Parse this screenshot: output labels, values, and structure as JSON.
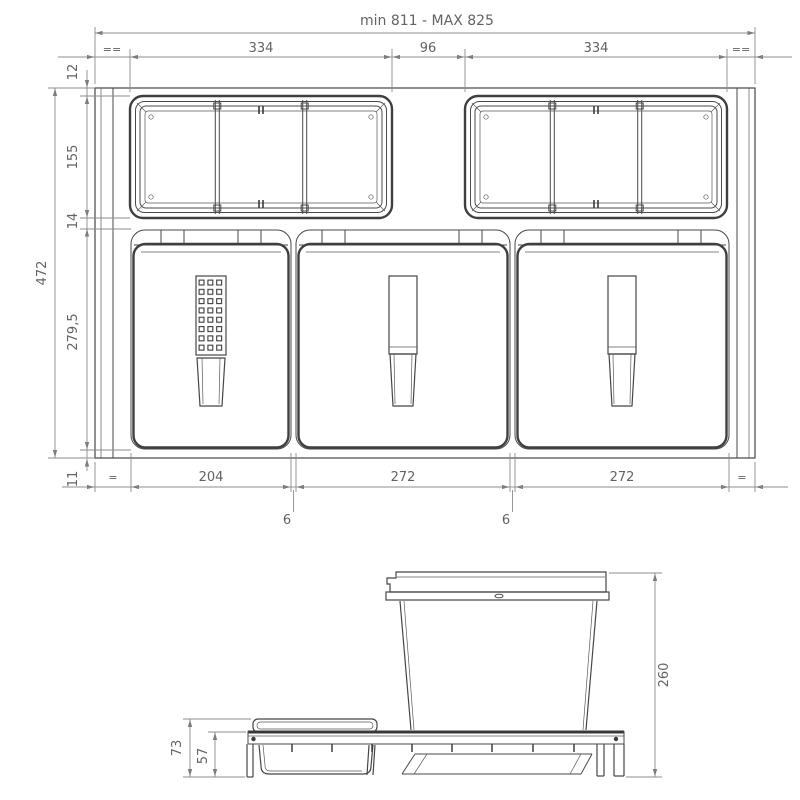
{
  "colors": {
    "line": "#4a4a4a",
    "bold_line": "#3f3f3f",
    "dim_line": "#8c8c8c",
    "dim_text": "#636363",
    "background": "#ffffff"
  },
  "top_view": {
    "overall_width": "min 811 - MAX 825",
    "tray_left_width": "334",
    "center_gap": "96",
    "tray_right_width": "334",
    "equal_top_left": "==",
    "equal_top_right": "==",
    "left_dims": {
      "front_gap": "12",
      "tray_depth": "155",
      "mid_gap": "14",
      "bin_depth": "279,5",
      "total_depth": "472",
      "back_gap": "11"
    },
    "bottom_dims": {
      "equal_left": "=",
      "bin1_width": "204",
      "bin2_width": "272",
      "bin3_width": "272",
      "equal_right": "=",
      "gap1": "6",
      "gap2": "6"
    }
  },
  "side_view": {
    "bin_height": "260",
    "tray_total_height": "73",
    "frame_height": "57"
  }
}
